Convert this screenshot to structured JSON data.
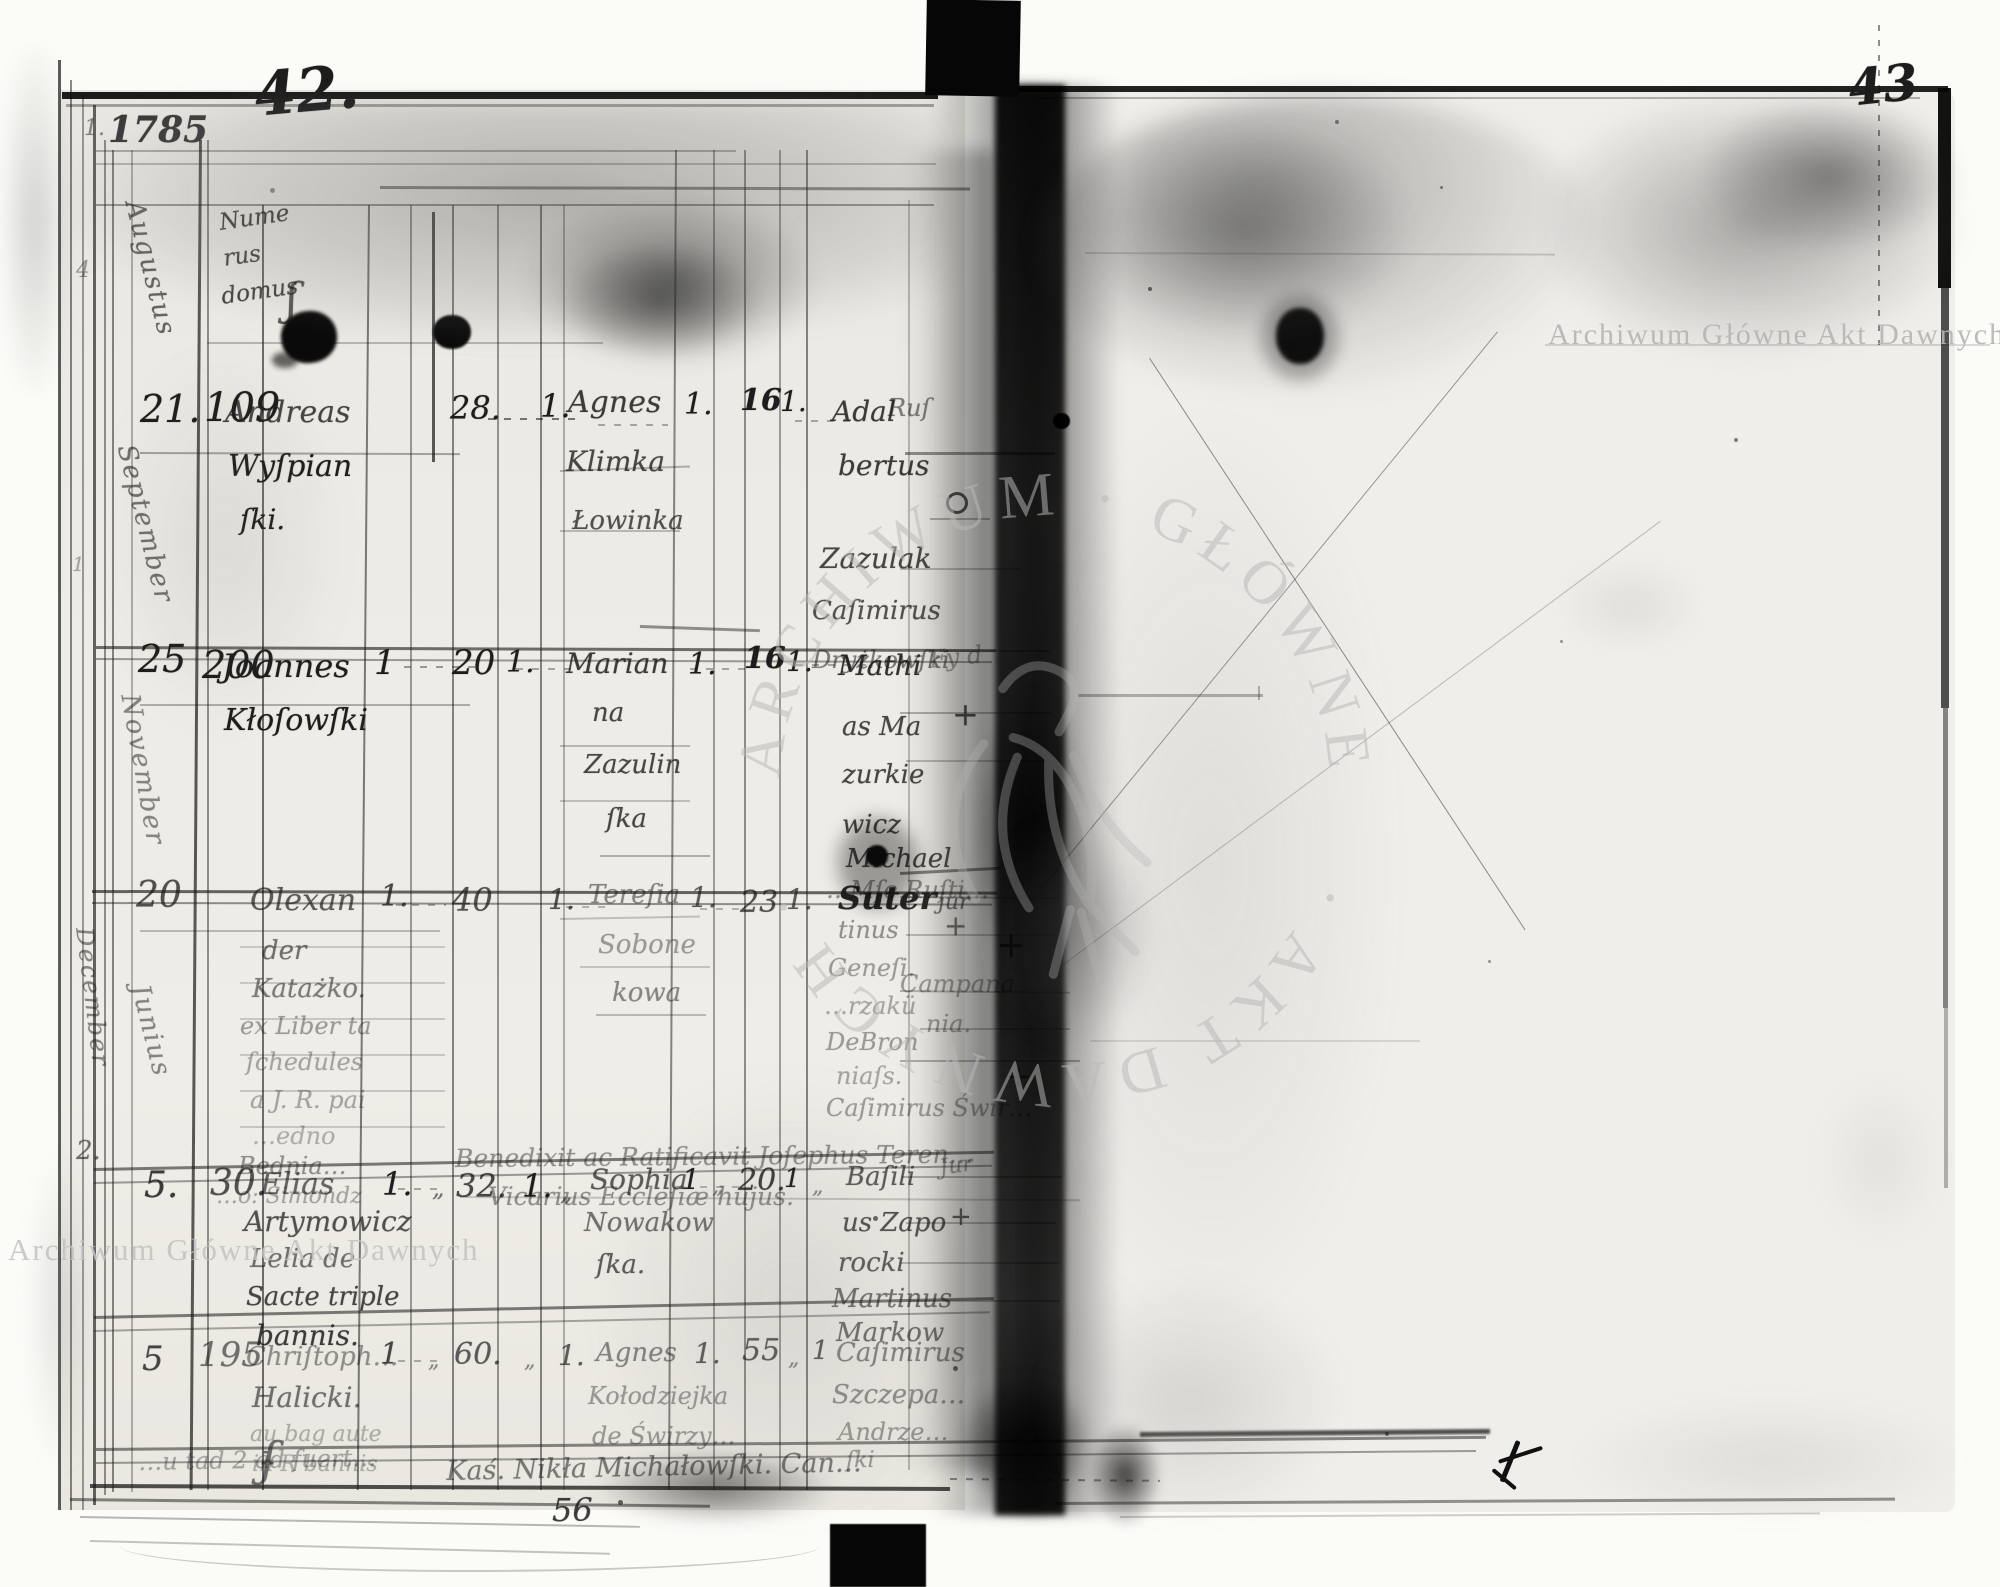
{
  "scan": {
    "archive_watermark": "Archiwum Główne Akt Dawnych",
    "ring_top": "ARCHIWUM · GŁÓWNE",
    "ring_bottom": "· AKT DAWNYCH ·",
    "left_page_number": "42.",
    "right_page_number": "43",
    "bottom_sheet_number": "56"
  },
  "header": {
    "margin_mark": "1.",
    "year": "1785",
    "month": "Augustus",
    "numerus": [
      "Nume",
      "rus",
      "domus"
    ],
    "flourish": "ʃ"
  },
  "margin": {
    "december": "December",
    "m2": "2.",
    "m4": "4",
    "m1": "1"
  },
  "glyphs": {
    "plus": "+",
    "ditto": "„",
    "jur": "jur",
    "jur2": "Jur",
    "fy": "Fy d",
    "u": "u"
  },
  "rows": [
    {
      "month": "September",
      "day": "21.",
      "domus": "109",
      "groom": [
        "Andreas",
        "Wyſpian",
        "ſki."
      ],
      "groom_age": "28.",
      "col2": "1.",
      "bride": [
        "Agnes",
        "Klimka",
        "Łowinka"
      ],
      "col3": "1.",
      "bride_age": "16",
      "col4": "1.",
      "witnesses": [
        "Adal",
        "bertus",
        "Zazulak",
        "Caſimirus",
        "Dryżkowſki"
      ],
      "side": "Ruſ"
    },
    {
      "month": "November",
      "day": "25",
      "domus": "200",
      "groom": [
        "Joannes",
        "Kłoſowſki"
      ],
      "col1": "1",
      "groom_age": "20",
      "col2": "1.",
      "bride": [
        "Marian",
        "na",
        "Zazulin",
        "ſka"
      ],
      "col3": "1.",
      "bride_age": "16",
      "col4": "1.",
      "witnesses": [
        "Mathi",
        "as Ma",
        "zurkie",
        "wicz",
        "Michael",
        "Suter"
      ]
    },
    {
      "month": "Junius",
      "day": "20",
      "domus": "",
      "groom": [
        "Olexan",
        "der",
        "Katażko.",
        "ex Liber ta",
        "ſchedules",
        "a J. R. pai",
        "…edno",
        "Bednia…",
        "…o: Simondz"
      ],
      "col1": "1.",
      "groom_age": "40",
      "col2": "1.",
      "bride": [
        "Tereſia",
        "Sobone",
        "kowa"
      ],
      "col3": "1.",
      "bride_age": "23",
      "col4": "1.",
      "witnesses": [
        "…Mſe Ruſti…",
        "tinus",
        "Geneſi.",
        "…rzakü",
        "DeBron",
        "niaſs.",
        "Caſimirus Świr…"
      ],
      "side": [
        "Campana",
        "nia."
      ],
      "note": [
        "Benedixit ac Ratificavit Joſephus Teren…",
        "Vicarius Eccleſiæ hujus."
      ]
    },
    {
      "month": "",
      "day": "5.",
      "domus": "30.",
      "groom": [
        "Elias",
        "Artymowicz",
        "Lelia de",
        "Sacte triple",
        "bannis."
      ],
      "col1": "1.",
      "ditto1": "„",
      "groom_age": "32.",
      "col2": "1.",
      "ditto2": "„",
      "bride": [
        "Sophia",
        "Nowakow",
        "ſka."
      ],
      "col3": "1",
      "ditto3": "„",
      "bride_age": "20.",
      "col4": "1",
      "ditto4": "„",
      "witnesses": [
        "Baſili",
        "us Zapo",
        "rocki",
        "Martinus",
        "Markow"
      ]
    },
    {
      "month": "",
      "day": "5",
      "domus": "195",
      "groom": [
        "Chriſtoph…",
        "Halicki.",
        "au bag aute",
        "in R bannis"
      ],
      "col1": "1",
      "ditto1": "„",
      "groom_age": "60.",
      "ditto2": "„",
      "col2": "1.",
      "bride": [
        "Agnes",
        "Kołodziejka",
        "de Świrzy…"
      ],
      "col3": "1.",
      "bride_age": "55",
      "ditto3": "„",
      "col4": "1",
      "witnesses": [
        "Caſimirus",
        "Szczepa…",
        "Andrze…",
        "ſki"
      ]
    }
  ],
  "bottom": {
    "left_fragment": "…u tad 2 ad fuert…",
    "flourish": "ʄ",
    "center_line": "Kaś. Nikła Michałowſki. Can…"
  }
}
